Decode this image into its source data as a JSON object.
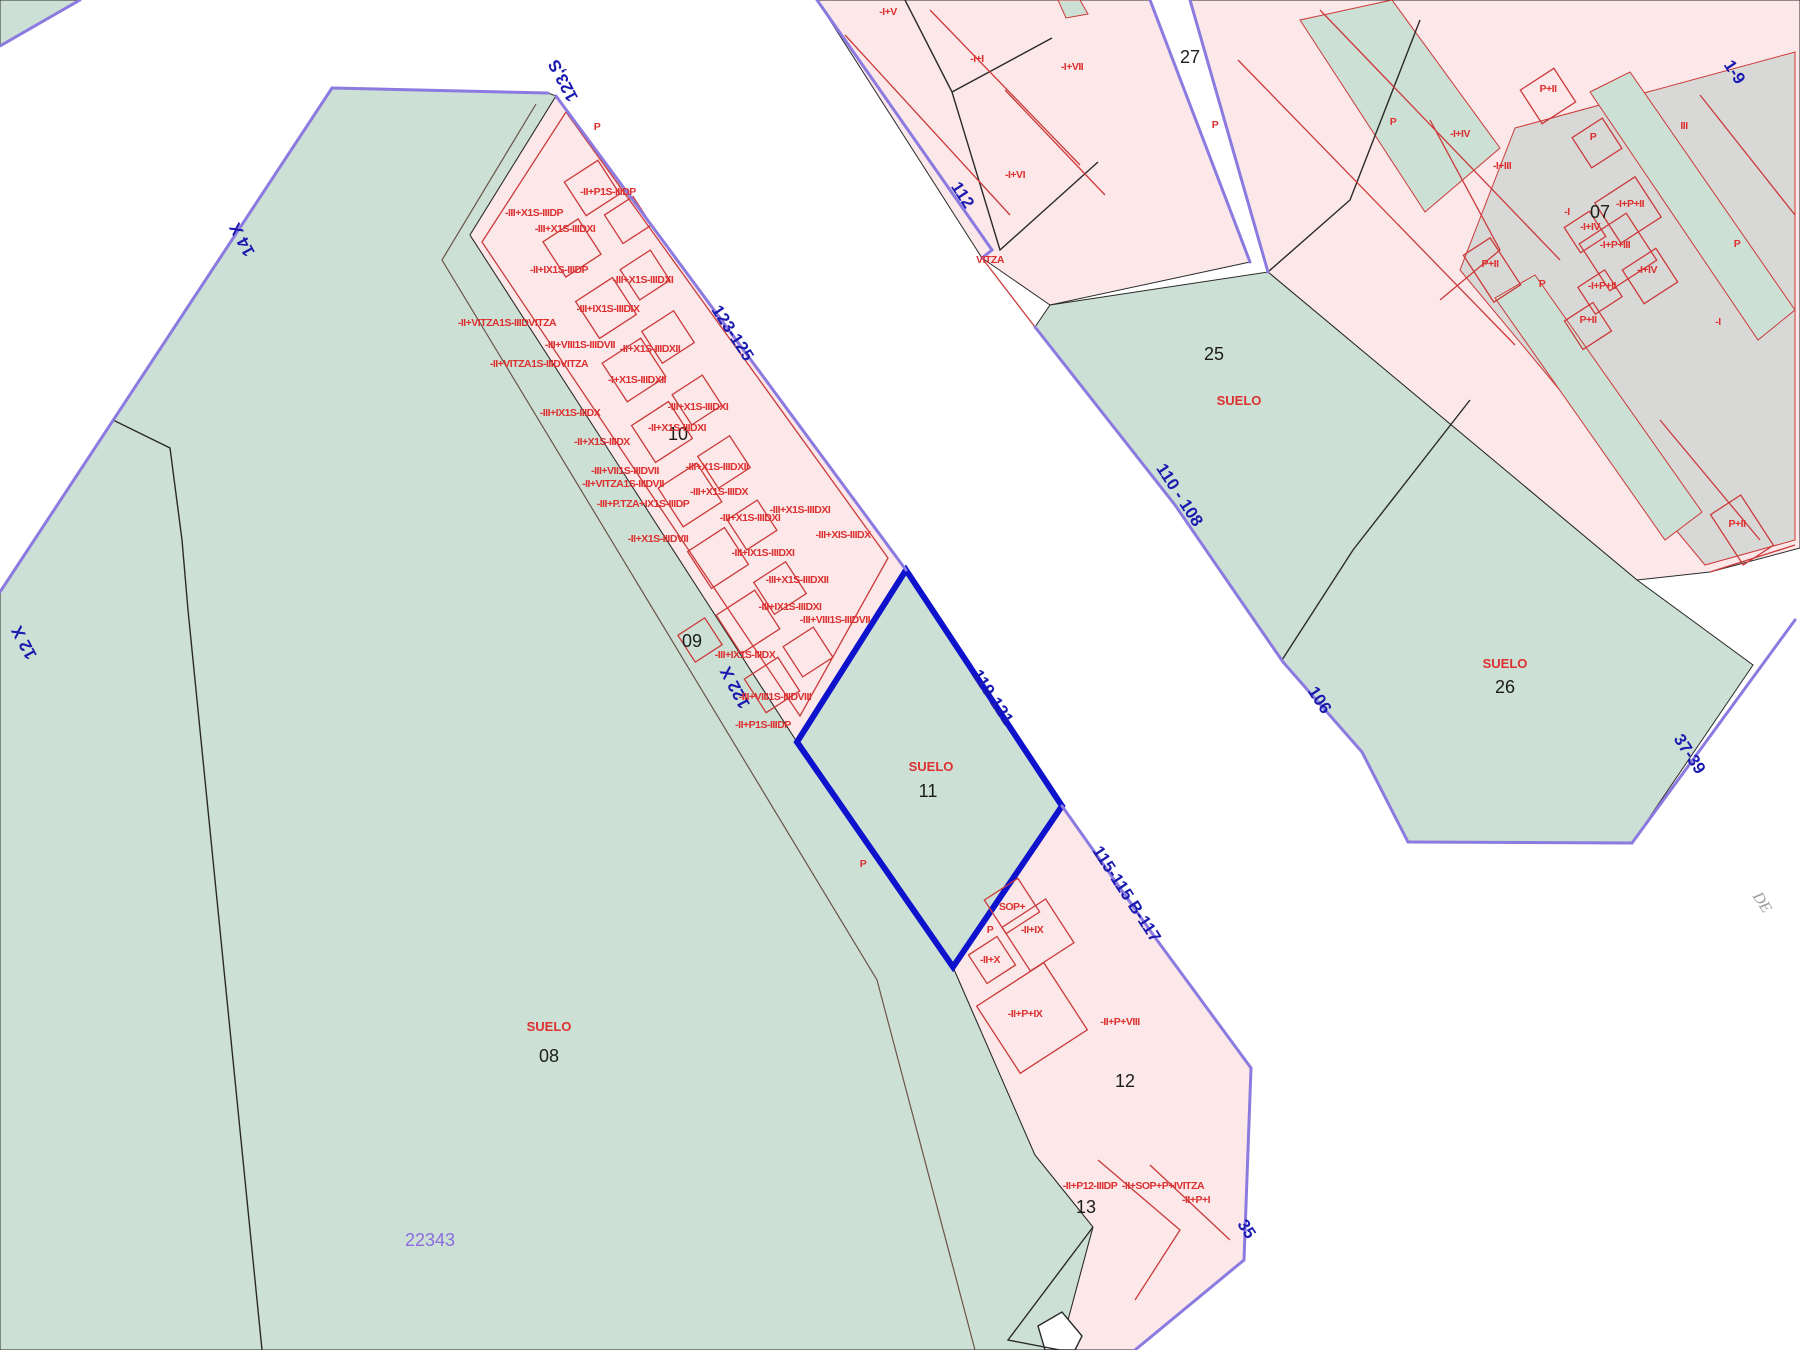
{
  "map": {
    "type": "cadastral-parcel-map",
    "colors": {
      "green": "#cde0d5",
      "pink": "#fce8e9",
      "grey": "#d8d9d7",
      "purple_line": "#8b7ae0",
      "blue_label": "#1a1ab0",
      "selected": "#0f12cc",
      "red_line": "#cc3a3a",
      "red_label": "#dd3030",
      "black_line": "#2a2a2a",
      "violet_text": "#8a6ce0",
      "grey_text": "#9b9b9b"
    },
    "selected_parcel": {
      "number": "11",
      "land_label": "SUELO"
    },
    "street_labels": [
      {
        "text": "123,S",
        "x": 568,
        "y": 78,
        "rot": -118
      },
      {
        "text": "14 X",
        "x": 247,
        "y": 237,
        "rot": -118
      },
      {
        "text": "12 X",
        "x": 29,
        "y": 640,
        "rot": -118
      },
      {
        "text": "123-125",
        "x": 728,
        "y": 336,
        "rot": 57
      },
      {
        "text": "122 X",
        "x": 740,
        "y": 685,
        "rot": -118
      },
      {
        "text": "119-121",
        "x": 988,
        "y": 700,
        "rot": 57
      },
      {
        "text": "115-115 B-117",
        "x": 1122,
        "y": 897,
        "rot": 57
      },
      {
        "text": "112",
        "x": 958,
        "y": 198,
        "rot": 57
      },
      {
        "text": "110 - 108",
        "x": 1175,
        "y": 498,
        "rot": 57
      },
      {
        "text": "106",
        "x": 1315,
        "y": 703,
        "rot": 57
      },
      {
        "text": "37-39",
        "x": 1685,
        "y": 757,
        "rot": 57
      },
      {
        "text": "1-9",
        "x": 1730,
        "y": 75,
        "rot": 57
      },
      {
        "text": "35",
        "x": 1242,
        "y": 1232,
        "rot": 57
      }
    ],
    "parcel_numbers": [
      {
        "text": "07",
        "x": 1600,
        "y": 218
      },
      {
        "text": "08",
        "x": 549,
        "y": 1062
      },
      {
        "text": "09",
        "x": 692,
        "y": 647
      },
      {
        "text": "10",
        "x": 678,
        "y": 440
      },
      {
        "text": "11",
        "x": 928,
        "y": 797
      },
      {
        "text": "12",
        "x": 1125,
        "y": 1087
      },
      {
        "text": "13",
        "x": 1086,
        "y": 1213
      },
      {
        "text": "25",
        "x": 1214,
        "y": 360
      },
      {
        "text": "26",
        "x": 1505,
        "y": 693
      },
      {
        "text": "27",
        "x": 1190,
        "y": 63
      }
    ],
    "suelo_labels": [
      {
        "text": "SUELO",
        "x": 1239,
        "y": 405
      },
      {
        "text": "SUELO",
        "x": 1505,
        "y": 668
      },
      {
        "text": "SUELO",
        "x": 931,
        "y": 771
      },
      {
        "text": "SUELO",
        "x": 549,
        "y": 1031
      }
    ],
    "building_labels": [
      {
        "text": "P",
        "x": 597,
        "y": 130
      },
      {
        "text": "-II+P1S-IIIDP",
        "x": 608,
        "y": 195
      },
      {
        "text": "-III+X1S-IIIDP",
        "x": 534,
        "y": 216
      },
      {
        "text": "-III+X1S-IIIDXI",
        "x": 565,
        "y": 232
      },
      {
        "text": "-II+IX1S-IIIDP",
        "x": 559,
        "y": 273
      },
      {
        "text": "-III+X1S-IIIDXI",
        "x": 643,
        "y": 283
      },
      {
        "text": "-III+IX1S-IIIDIX",
        "x": 608,
        "y": 312
      },
      {
        "text": "-II+VITZA1S-IIIDVITZA",
        "x": 507,
        "y": 326
      },
      {
        "text": "-III+VIII1S-IIIDVII",
        "x": 580,
        "y": 348
      },
      {
        "text": "-II+X1S-IIIDXII",
        "x": 650,
        "y": 352
      },
      {
        "text": "-II+VITZA1S-IIIDVITZA",
        "x": 539,
        "y": 367
      },
      {
        "text": "-I+X1S-IIIDXII",
        "x": 637,
        "y": 383
      },
      {
        "text": "-III+IX1S-IIIDX",
        "x": 570,
        "y": 416
      },
      {
        "text": "-III+X1S-IIIDXI",
        "x": 698,
        "y": 410
      },
      {
        "text": "-II+X1S-IIIDXI",
        "x": 677,
        "y": 431
      },
      {
        "text": "-II+X1S-IIIDX",
        "x": 602,
        "y": 445
      },
      {
        "text": "-III+VII1S-IIIDVII",
        "x": 625,
        "y": 474
      },
      {
        "text": "-III+X1S-IIIDXII",
        "x": 717,
        "y": 470
      },
      {
        "text": "-II+VITZA1S-IIIDVII",
        "x": 623,
        "y": 487
      },
      {
        "text": "-III+X1S-IIIDX",
        "x": 719,
        "y": 495
      },
      {
        "text": "-III+P.TZA+IX1S-IIIDP",
        "x": 643,
        "y": 507
      },
      {
        "text": "-III+X1S-IIIDXI",
        "x": 750,
        "y": 521
      },
      {
        "text": "-II+X1S-IIIDVII",
        "x": 658,
        "y": 542
      },
      {
        "text": "-III+X1S-IIIDXI",
        "x": 800,
        "y": 513
      },
      {
        "text": "-III+XIS-IIIDX",
        "x": 843,
        "y": 538
      },
      {
        "text": "-III+IX1S-IIIDXI",
        "x": 763,
        "y": 556
      },
      {
        "text": "-III+X1S-IIIDXII",
        "x": 797,
        "y": 583
      },
      {
        "text": "-III+IX1S-IIIDXI",
        "x": 790,
        "y": 610
      },
      {
        "text": "-III+VIII1S-IIIDVII",
        "x": 835,
        "y": 623
      },
      {
        "text": "-III+IX1S-IIIDX",
        "x": 745,
        "y": 658
      },
      {
        "text": "-III+VIII1S-IIIDVIII",
        "x": 775,
        "y": 700
      },
      {
        "text": "-II+P1S-IIIDP",
        "x": 763,
        "y": 728
      },
      {
        "text": "P",
        "x": 863,
        "y": 867
      },
      {
        "text": "SOP+",
        "x": 1012,
        "y": 910
      },
      {
        "text": "P",
        "x": 990,
        "y": 933
      },
      {
        "text": "-II+IX",
        "x": 1032,
        "y": 933
      },
      {
        "text": "-II+X",
        "x": 990,
        "y": 963
      },
      {
        "text": "-II+P+IX",
        "x": 1025,
        "y": 1017
      },
      {
        "text": "-II+P+VIII",
        "x": 1120,
        "y": 1025
      },
      {
        "text": "-II+P12-IIIDP",
        "x": 1090,
        "y": 1189
      },
      {
        "text": "-II+SOP+P+IVITZA",
        "x": 1163,
        "y": 1189
      },
      {
        "text": "-II+P+I",
        "x": 1196,
        "y": 1203
      },
      {
        "text": "-I+V",
        "x": 888,
        "y": 15
      },
      {
        "text": "-I+I",
        "x": 977,
        "y": 62
      },
      {
        "text": "-I+VII",
        "x": 1072,
        "y": 70
      },
      {
        "text": "-I+VI",
        "x": 1015,
        "y": 178
      },
      {
        "text": "VITZA",
        "x": 990,
        "y": 263
      },
      {
        "text": "P",
        "x": 1393,
        "y": 125
      },
      {
        "text": "-I+IV",
        "x": 1460,
        "y": 137
      },
      {
        "text": "-I+III",
        "x": 1502,
        "y": 169
      },
      {
        "text": "P+II",
        "x": 1548,
        "y": 92
      },
      {
        "text": "III",
        "x": 1684,
        "y": 129
      },
      {
        "text": "P",
        "x": 1593,
        "y": 140
      },
      {
        "text": "-I+P+II",
        "x": 1630,
        "y": 207
      },
      {
        "text": "-I",
        "x": 1567,
        "y": 215
      },
      {
        "text": "-I+IV",
        "x": 1590,
        "y": 230
      },
      {
        "text": "-I+P+III",
        "x": 1615,
        "y": 248
      },
      {
        "text": "-I+IV",
        "x": 1647,
        "y": 273
      },
      {
        "text": "-I+P+II",
        "x": 1602,
        "y": 289
      },
      {
        "text": "P+II",
        "x": 1588,
        "y": 323
      },
      {
        "text": "P",
        "x": 1737,
        "y": 247
      },
      {
        "text": "-I",
        "x": 1718,
        "y": 325
      },
      {
        "text": "P+II",
        "x": 1490,
        "y": 267
      },
      {
        "text": "P",
        "x": 1542,
        "y": 287
      },
      {
        "text": "P+II",
        "x": 1737,
        "y": 527
      },
      {
        "text": "P",
        "x": 1215,
        "y": 128
      }
    ],
    "misc_labels": [
      {
        "text": "22343",
        "x": 430,
        "y": 1246,
        "rot": 0,
        "cls": "t-violet"
      },
      {
        "text": "DE",
        "x": 1758,
        "y": 905,
        "rot": 57,
        "cls": "t-grey"
      }
    ]
  }
}
